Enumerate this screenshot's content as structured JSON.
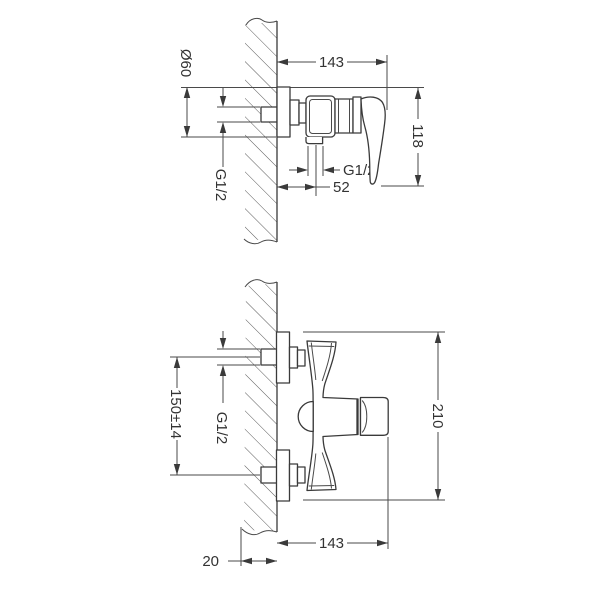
{
  "drawing": {
    "background": "#ffffff",
    "line_color": "#3a3a3a",
    "side_view": {
      "width": "143",
      "escutcheon_diameter": "Ø60",
      "height": "118",
      "inlet_thread": "G1/2",
      "outlet_thread": "G1/2",
      "outlet_offset": "52"
    },
    "front_view": {
      "inlet_spacing": "150±14",
      "inlet_thread": "G1/2",
      "overall_height": "210",
      "width": "143",
      "wall_clearance": "20"
    }
  }
}
